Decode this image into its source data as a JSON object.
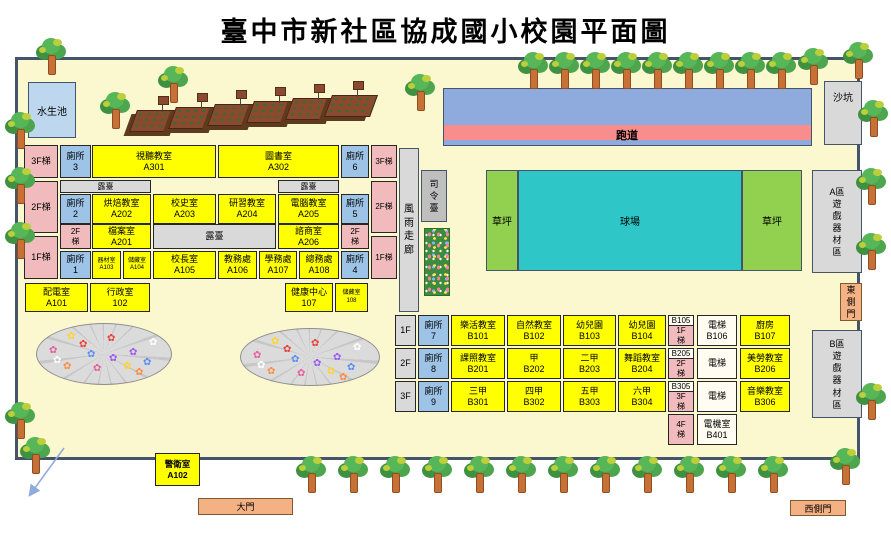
{
  "title": "臺中市新社區協成國小校園平面圖",
  "facilities": {
    "water_pond": "水生池",
    "sand_pit": "沙坑",
    "track": "跑道",
    "court": "球場",
    "lawn_left": "草坪",
    "lawn_right": "草坪",
    "equip_a_line1": "A區",
    "equip_a_rest": "遊戲器材區",
    "equip_b_line1": "B區",
    "equip_b_rest": "遊戲器材區",
    "corridor": "風雨走廊",
    "podium": "司令臺",
    "main_gate": "大門",
    "east_gate": "東側門",
    "west_gate": "西側門"
  },
  "guard_room": {
    "name": "警衛室",
    "code": "A102"
  },
  "building_a": {
    "terrace": "露臺",
    "stairs": {
      "l3": "3F梯",
      "l2": "2F梯",
      "l1": "1F梯",
      "r3": "3F梯",
      "r2": "2F梯",
      "r1": "1F梯",
      "il2": "2F梯",
      "ir2": "2F梯"
    },
    "toilets": {
      "t1": {
        "name": "廁所",
        "code": "1"
      },
      "t2": {
        "name": "廁所",
        "code": "2"
      },
      "t3": {
        "name": "廁所",
        "code": "3"
      },
      "t4": {
        "name": "廁所",
        "code": "4"
      },
      "t5": {
        "name": "廁所",
        "code": "5"
      },
      "t6": {
        "name": "廁所",
        "code": "6"
      }
    },
    "rooms": {
      "a301": {
        "name": "視聽教室",
        "code": "A301"
      },
      "a302": {
        "name": "圖書室",
        "code": "A302"
      },
      "a202": {
        "name": "烘焙教室",
        "code": "A202"
      },
      "a203": {
        "name": "校史室",
        "code": "A203"
      },
      "a204": {
        "name": "研習教室",
        "code": "A204"
      },
      "a205": {
        "name": "電腦教室",
        "code": "A205"
      },
      "a201": {
        "name": "檔案室",
        "code": "A201"
      },
      "a206": {
        "name": "諮商室",
        "code": "A206"
      },
      "a103": {
        "name": "器材室",
        "code": "A103"
      },
      "a104": {
        "name": "儲藏室",
        "code": "A104"
      },
      "a105": {
        "name": "校長室",
        "code": "A105"
      },
      "a106": {
        "name": "教務處",
        "code": "A106"
      },
      "a107": {
        "name": "學務處",
        "code": "A107"
      },
      "a108": {
        "name": "總務處",
        "code": "A108"
      },
      "a101": {
        "name": "配電室",
        "code": "A101"
      },
      "r102": {
        "name": "行政室",
        "code": "102"
      },
      "r107": {
        "name": "健康中心",
        "code": "107"
      },
      "r108": {
        "name": "儲藏室",
        "code": "108"
      }
    }
  },
  "building_b": {
    "rows": [
      {
        "floor": "1F",
        "toilet": {
          "name": "廁所",
          "code": "7"
        },
        "rooms": [
          {
            "name": "樂活教室",
            "code": "B101"
          },
          {
            "name": "自然教室",
            "code": "B102"
          },
          {
            "name": "幼兒園",
            "code": "B103"
          },
          {
            "name": "幼兒園",
            "code": "B104"
          }
        ],
        "stair": {
          "code": "B105",
          "label": "1F梯"
        },
        "elev": {
          "name": "電梯",
          "code": "B106"
        },
        "right": {
          "name": "廚房",
          "code": "B107"
        }
      },
      {
        "floor": "2F",
        "toilet": {
          "name": "廁所",
          "code": "8"
        },
        "rooms": [
          {
            "name": "課照教室",
            "code": "B201"
          },
          {
            "name": "甲",
            "code": "B202"
          },
          {
            "name": "二甲",
            "code": "B203"
          },
          {
            "name": "舞蹈教室",
            "code": "B204"
          }
        ],
        "stair": {
          "code": "B205",
          "label": "2F梯"
        },
        "elev": {
          "name": "電梯"
        },
        "right": {
          "name": "美勞教室",
          "code": "B206"
        }
      },
      {
        "floor": "3F",
        "toilet": {
          "name": "廁所",
          "code": "9"
        },
        "rooms": [
          {
            "name": "三甲",
            "code": "B301"
          },
          {
            "name": "四甲",
            "code": "B302"
          },
          {
            "name": "五甲",
            "code": "B303"
          },
          {
            "name": "六甲",
            "code": "B304"
          }
        ],
        "stair": {
          "code": "B305",
          "label": "3F梯"
        },
        "elev": {
          "name": "電梯"
        },
        "right": {
          "name": "音樂教室",
          "code": "B306"
        }
      }
    ],
    "stair4": "4F梯",
    "b401": {
      "name": "電機室",
      "code": "B401"
    }
  },
  "colors": {
    "room_yellow": "#FFFF00",
    "toilet_blue": "#9DC3E6",
    "stair_pink": "#F1BBBD",
    "terrace_gray": "#D9D9D9",
    "track_blue": "#8FAADC",
    "track_lane_pink": "#F98C8C",
    "court_teal": "#2EC6C6",
    "lawn_green": "#92D050",
    "gate_orange": "#F4B183",
    "pond_blue": "#BDD7EE",
    "boundary": "#44546A",
    "ground": "#FBF7CE"
  }
}
